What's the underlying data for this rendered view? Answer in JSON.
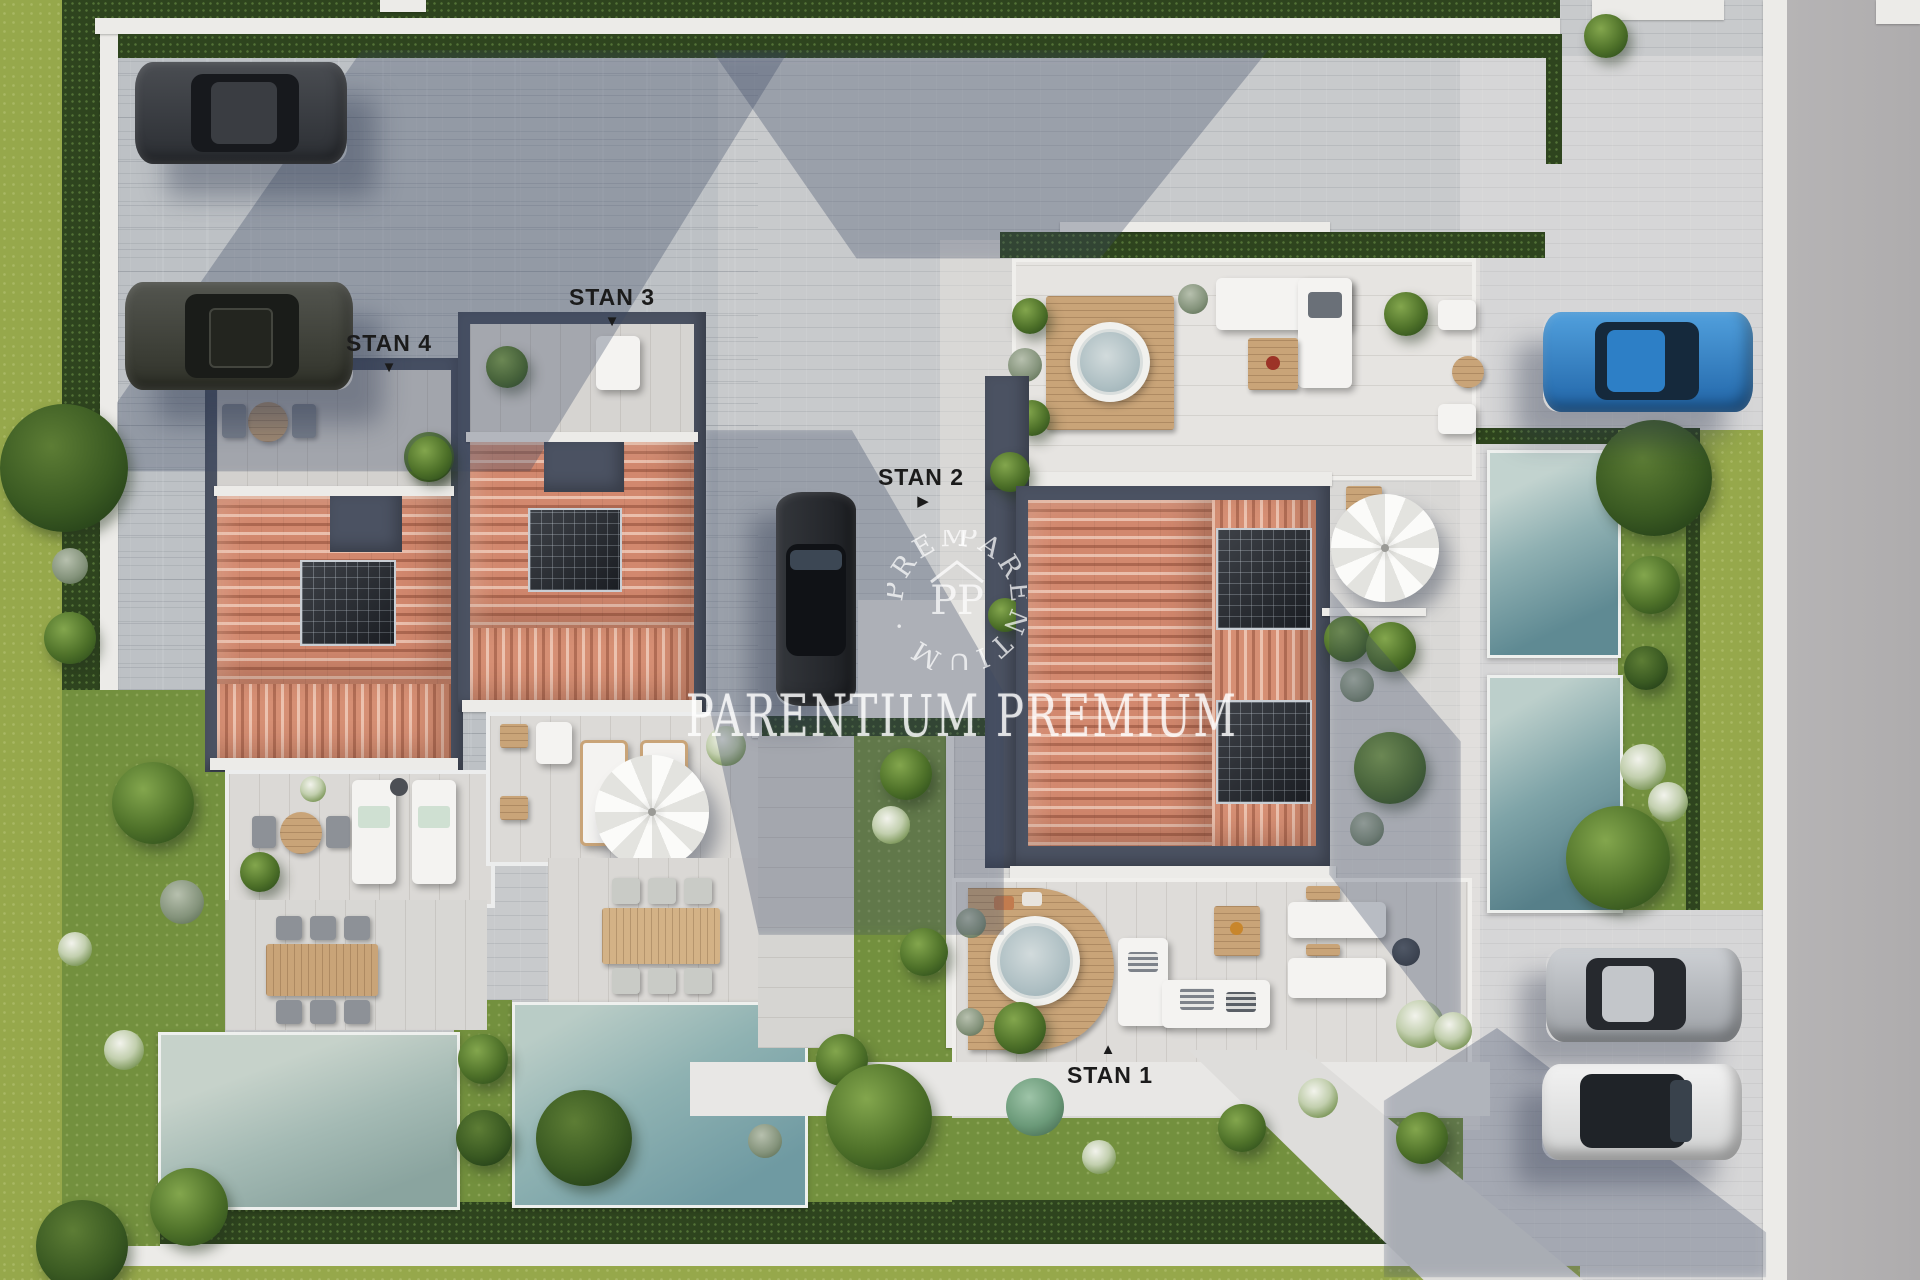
{
  "watermark": {
    "title": "PARENTIUM PREMIUM",
    "logo_ring_text": "PARENTIUM · PREMIUM ·",
    "logo_monogram": "PP"
  },
  "unit_labels": {
    "stan1": {
      "label": "STAN 1",
      "arrow": "▲"
    },
    "stan2": {
      "label": "STAN 2",
      "arrow": "▶"
    },
    "stan3": {
      "label": "STAN 3",
      "arrow": "▼"
    },
    "stan4": {
      "label": "STAN 4",
      "arrow": "▼"
    }
  },
  "palette": {
    "paving": "#c8cacc",
    "roof_terracotta": "#d2886e",
    "flat_roof_dark": "#4b5262",
    "pool_teal": "#6f9aa2",
    "pool_pale": "#aec1ba",
    "lawn": "#96a84b",
    "hedge": "#2e441e",
    "car_blue": "#2d7fc6",
    "wood_deck": "#c9a478",
    "shadow_blue": "#3a4864"
  }
}
